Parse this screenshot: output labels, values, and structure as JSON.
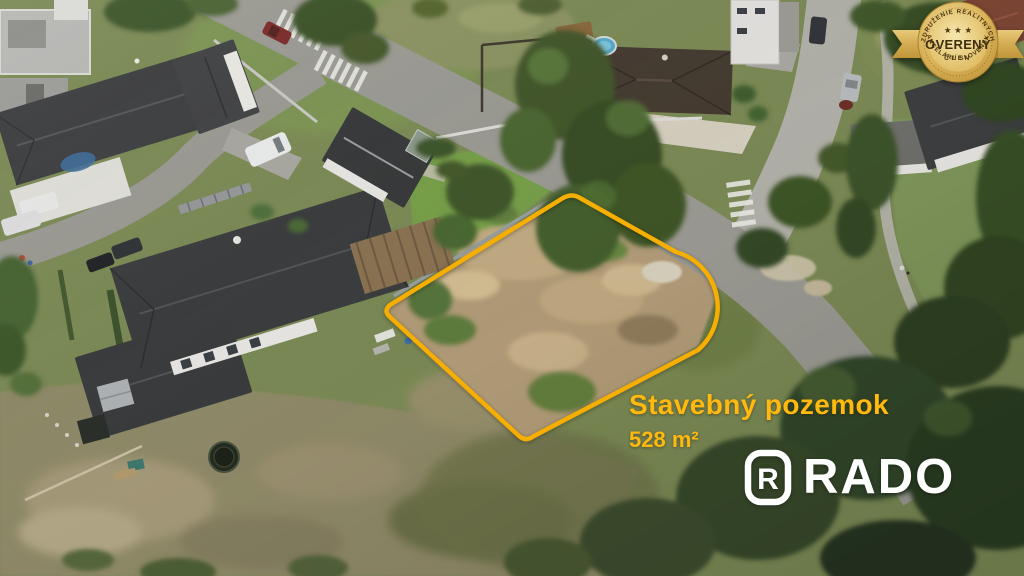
{
  "overlay": {
    "title": "Stavebný pozemok",
    "area": "528 m²",
    "text_color": "#FFB90F"
  },
  "logo": {
    "text": "RADO",
    "icon_letter": "R",
    "color": "#FFFFFF"
  },
  "badge": {
    "arc_top": "ZDRUŽENIE REALITNÝCH",
    "main": "OVERENÝ",
    "sub": "ČLEN",
    "arc_bottom": "KANCELÁRIÍ SLOVENSKA",
    "stars": "★ ★ ★",
    "gold_light": "#EED592",
    "gold_dark": "#C09238",
    "text_color": "#4A370F"
  },
  "plot": {
    "outline_color": "#F6AE00"
  }
}
